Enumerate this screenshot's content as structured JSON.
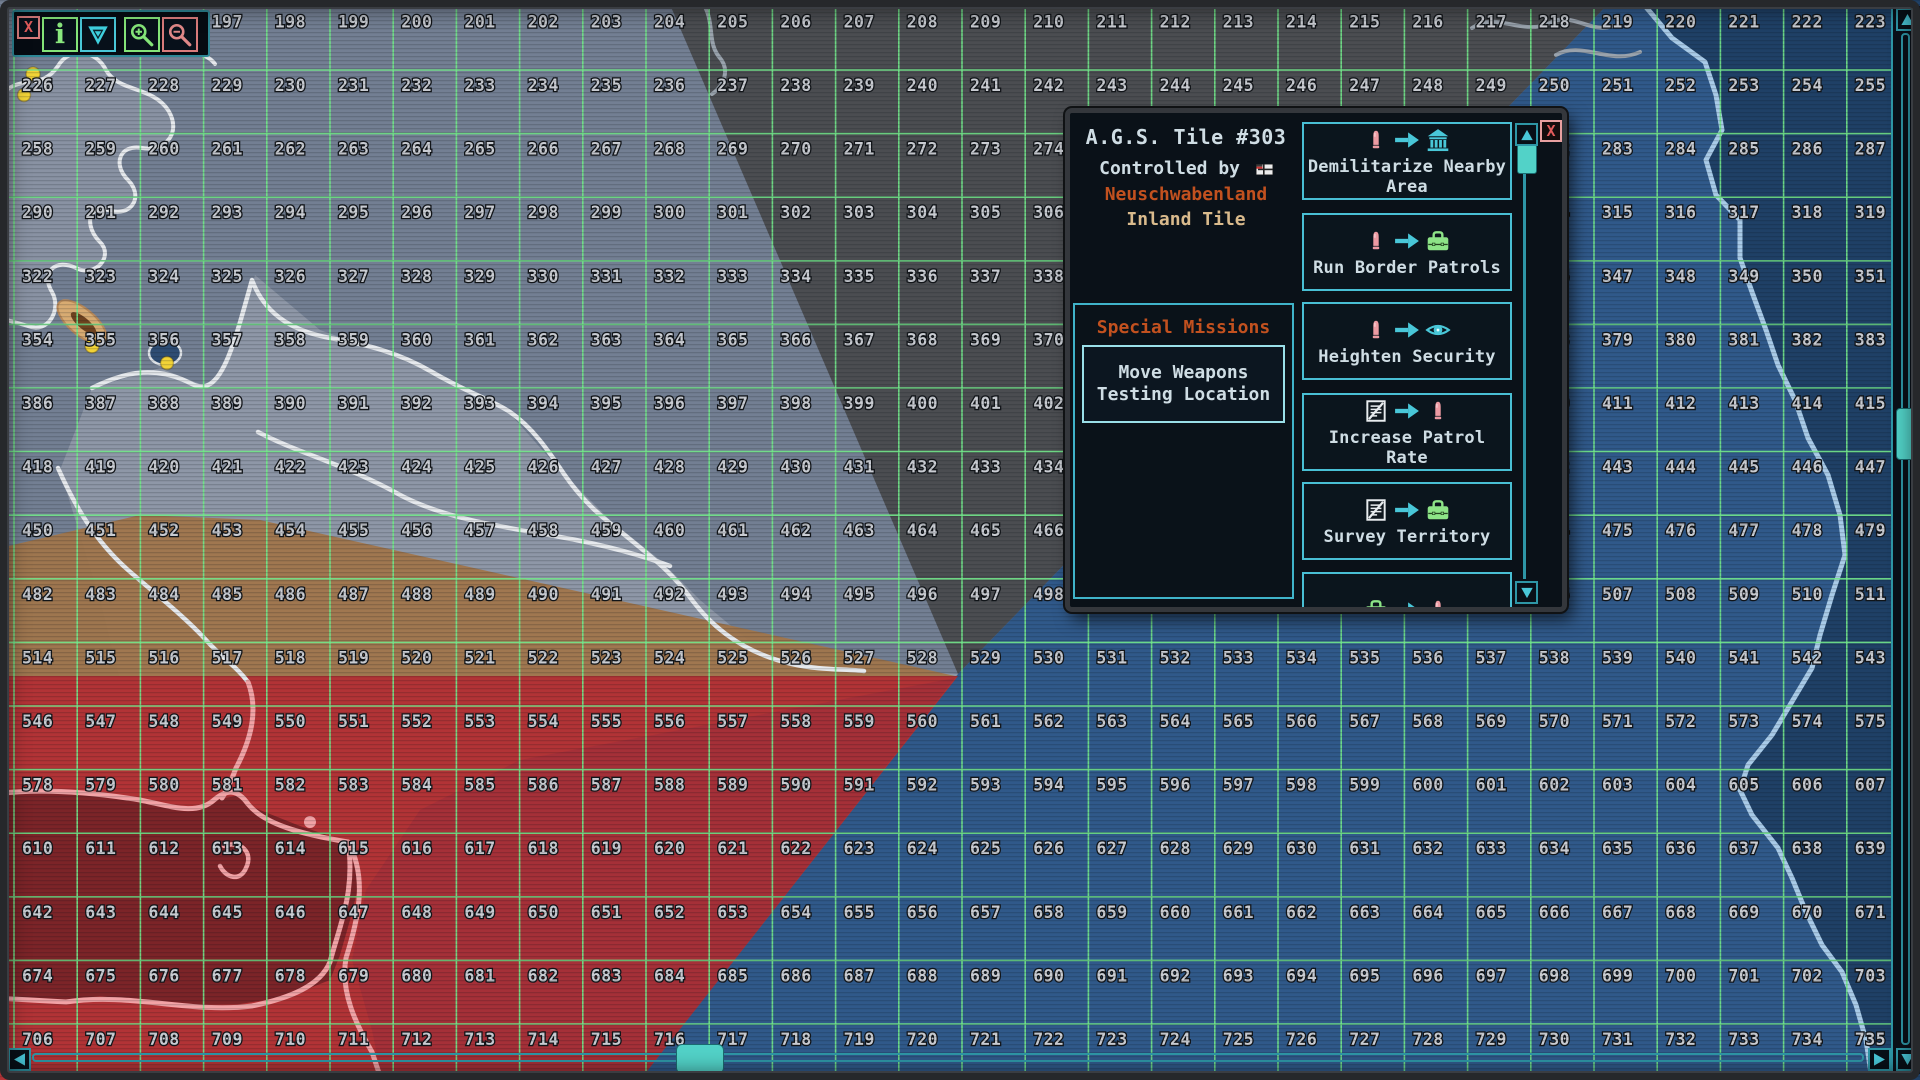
{
  "theme": {
    "accent_cyan": "#49c7d8",
    "accent_orange": "#c2511f",
    "tan": "#d9ba8c",
    "text_light": "#cfdde4",
    "close_red": "#e25c5c",
    "button_green": "#84e478",
    "button_pink": "#d97b7b"
  },
  "toolbar": {
    "buttons": [
      {
        "name": "close",
        "icon": "x-icon",
        "glyph": "X"
      },
      {
        "name": "info",
        "icon": "info-icon",
        "glyph": "i"
      },
      {
        "name": "marker",
        "icon": "triangle-flag-icon"
      },
      {
        "name": "zoom-in",
        "icon": "zoom-in-icon"
      },
      {
        "name": "zoom-out",
        "icon": "zoom-out-icon"
      }
    ]
  },
  "map": {
    "grid": {
      "row_starts": [
        194,
        226,
        258,
        290,
        322,
        354,
        386,
        418,
        450,
        482,
        514,
        546,
        578,
        610,
        642,
        674,
        706
      ],
      "visible_columns": 30,
      "col_increment": 1,
      "row_increment": 32
    },
    "colors": {
      "sea_slate": "#737f93",
      "inland_slate": "#8e97a7",
      "dark_sector": "#4b4d51",
      "blue_land": "#30598a",
      "ocean_navy": "#1f4066",
      "red_land": "#b23336",
      "red_bay": "#7c2428",
      "red_east": "#a23038",
      "brown_band": "#a0764c",
      "coast_white": "#e6e9ed",
      "coast_pink": "#f2a3a6",
      "coast_blue": "#a9cbe8",
      "coast_gray": "#9aa3ad",
      "grid_line": "#72e589",
      "tile_number": "#c9ccd2",
      "marker_yellow": "#f2d337",
      "pond_blue": "#2e4d74",
      "mountain_tan": "#d8ab72",
      "mountain_core": "#6e421f",
      "scroll_cyan": "#52d2c8"
    }
  },
  "dialog": {
    "title": "A.G.S. Tile #303",
    "controlled_by_label": "Controlled by",
    "controller_name": "Neuschwabenland",
    "tile_type": "Inland Tile",
    "special_missions_header": "Special Missions",
    "special_mission_button": "Move Weapons Testing Location",
    "missions": [
      {
        "label": "Demilitarize Nearby Area",
        "icons": [
          "bullet",
          "arrow",
          "bank"
        ]
      },
      {
        "label": "Run Border Patrols",
        "icons": [
          "bullet",
          "arrow",
          "briefcase"
        ]
      },
      {
        "label": "Heighten Security",
        "icons": [
          "bullet",
          "arrow",
          "eye"
        ]
      },
      {
        "label": "Increase Patrol Rate",
        "icons": [
          "document",
          "arrow",
          "bullet"
        ]
      },
      {
        "label": "Survey Territory",
        "icons": [
          "document",
          "arrow",
          "briefcase"
        ]
      },
      {
        "label": "",
        "icons": [
          "briefcase",
          "arrow",
          "bullet"
        ]
      }
    ]
  }
}
